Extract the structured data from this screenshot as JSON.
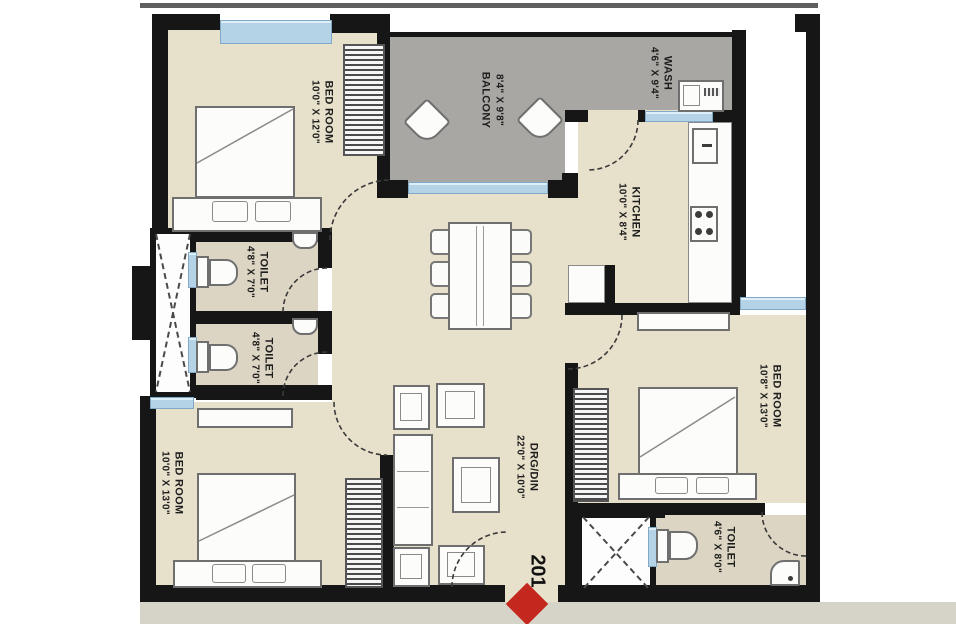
{
  "plan": {
    "title": "apartment-floor-plan",
    "unit_number": "201",
    "rooms": [
      {
        "id": "bedroom-top-left",
        "name": "BED ROOM",
        "dims": "10'0\" X 12'0\""
      },
      {
        "id": "balcony",
        "name": "BALCONY",
        "dims": "8'4\" X 9'8\""
      },
      {
        "id": "wash",
        "name": "WASH",
        "dims": "4'6\" X 9'4\""
      },
      {
        "id": "kitchen",
        "name": "KITCHEN",
        "dims": "10'0\" X 8'4\""
      },
      {
        "id": "toilet-upper",
        "name": "TOILET",
        "dims": "4'8\" X 7'0\""
      },
      {
        "id": "toilet-lower",
        "name": "TOILET",
        "dims": "4'8\" X 7'0\""
      },
      {
        "id": "bedroom-bottom-left",
        "name": "BED ROOM",
        "dims": "10'0\" X 13'0\""
      },
      {
        "id": "drawing-dining",
        "name": "DRG/DIN",
        "dims": "22'0\" X 10'0\""
      },
      {
        "id": "bedroom-right",
        "name": "BED ROOM",
        "dims": "10'8\" X 13'0\""
      },
      {
        "id": "toilet-bottom-right",
        "name": "TOILET",
        "dims": "4'6\" X 8'0\""
      }
    ],
    "colors": {
      "wall": "#161616",
      "room_floor": "#e7e0ca",
      "toilet_floor": "#dcd5c3",
      "balcony_floor": "#a9a7a3",
      "window_glass": "#b5d3e6",
      "entrance_marker": "#c4271d",
      "footer_band": "#d6d3c9"
    }
  }
}
